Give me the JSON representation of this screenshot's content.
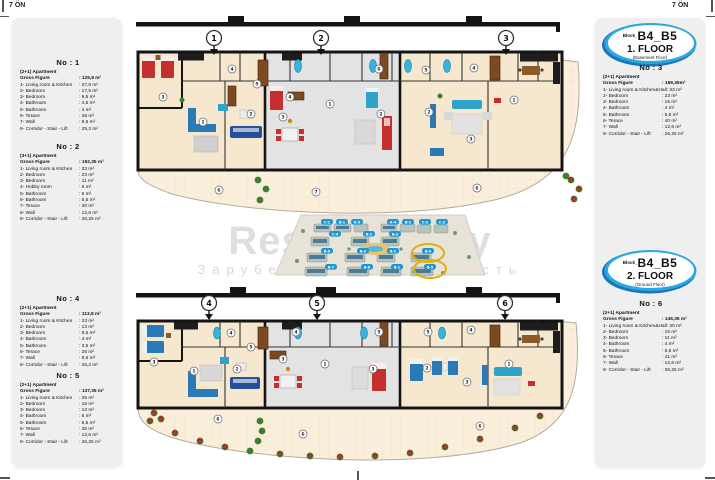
{
  "page": {
    "corner_left": "7 ÖN",
    "corner_right": "7 ÖN"
  },
  "watermark": {
    "title": "RestProperty",
    "subtitle": "Зарубежная недвижимость"
  },
  "colors": {
    "badge_blue": "#2aa9e0",
    "badge_dark_blue": "#1b75bb",
    "wall": "#1a1a1a",
    "floor_cream": "#f6e8cf",
    "floor_gray": "#e3e3e3",
    "terrace_cream": "#f9efdb",
    "furniture_red": "#c62f2f",
    "furniture_blue": "#2a7ab8",
    "furniture_navy": "#274f99",
    "tub_cyan": "#35b4dc",
    "plant_green": "#3f7d33",
    "label_blue": "#1f97d4",
    "highlight_yellow": "#e2b00c",
    "panel_gray": "#efefef"
  },
  "badges": {
    "floor1": {
      "block": "Block_",
      "name": "B4_B5",
      "floor": "1. FLOOR",
      "sub": "(Basement Floor)"
    },
    "floor2": {
      "block": "Block_",
      "name": "B4_B5",
      "floor": "2. FLOOR",
      "sub": "(Ground Floor)"
    }
  },
  "apartments": [
    {
      "no": "No : 1",
      "type": "(2+1) Apartment",
      "gross_label": "Gross Figure",
      "gross_value": ": 125,8 m²",
      "rows": [
        {
          "label": "1- Living room & Kitchen",
          "value": ": 27,5 m²"
        },
        {
          "label": "2- Bedroom",
          "value": ": 17,5 m²"
        },
        {
          "label": "3- Bedroom",
          "value": ": 9,5 m²"
        },
        {
          "label": "4- Bathroom",
          "value": ": 4,5 m²"
        },
        {
          "label": "5- Bathroom",
          "value": ": 4 m²"
        },
        {
          "label": "6- Terace",
          "value": ": 28 m²"
        },
        {
          "label": "7- Wall",
          "value": ": 9,6 m²"
        },
        {
          "label": "8- Corridor - Stair - Lift",
          "value": ": 25,2 m²"
        }
      ]
    },
    {
      "no": "No : 2",
      "type": "(3+1) Apartment",
      "gross_label": "Gross Figure",
      "gross_value": ": 152,35 m²",
      "rows": [
        {
          "label": "1- Living room & Kitchen",
          "value": ": 33 m²"
        },
        {
          "label": "2- Bedroom",
          "value": ": 23 m²"
        },
        {
          "label": "3- Bedroom",
          "value": ": 11 m²"
        },
        {
          "label": "4- Hobby room",
          "value": ": 6 m²"
        },
        {
          "label": "5- Bathroom",
          "value": ": 5 m²"
        },
        {
          "label": "6- Bathroom",
          "value": ": 5,5 m²"
        },
        {
          "label": "7- Terace",
          "value": ": 30 m²"
        },
        {
          "label": "8- Wall",
          "value": ": 12,6 m²"
        },
        {
          "label": "9- Corridor - Stair - Lift",
          "value": ": 26,25 m²"
        }
      ]
    },
    {
      "no": "No : 3",
      "type": "(2+1) Apartment",
      "gross_label": "Gross Figure",
      "gross_value": ": 159,35m²",
      "rows": [
        {
          "label": "1- Living room & Kitchen&Hall",
          "value": ": 33 m²"
        },
        {
          "label": "2- Bedroom",
          "value": ": 23 m²"
        },
        {
          "label": "3- Bedroom",
          "value": ": 15 m²"
        },
        {
          "label": "4- Bathroom",
          "value": ": 4 m²"
        },
        {
          "label": "5- Bathroom",
          "value": ": 5,5 m²"
        },
        {
          "label": "6- Terace",
          "value": ": 40 m²"
        },
        {
          "label": "7- Wall",
          "value": ": 12,6 m²"
        },
        {
          "label": "8- Corridor - Stair - Lift",
          "value": ": 26,25 m²"
        }
      ]
    },
    {
      "no": "No : 4",
      "type": "(2+1) Apartment",
      "gross_label": "Gross Figure",
      "gross_value": ": 113,8 m²",
      "rows": [
        {
          "label": "1- Living room & Kitchen",
          "value": ": 23 m²"
        },
        {
          "label": "2- Bedroom",
          "value": ": 13 m²"
        },
        {
          "label": "3- Bedroom",
          "value": ": 9,5 m²"
        },
        {
          "label": "4- Bathroom",
          "value": ": 4 m²"
        },
        {
          "label": "5- Bathroom",
          "value": ": 3,5 m²"
        },
        {
          "label": "6- Terace",
          "value": ": 26 m²"
        },
        {
          "label": "7- Wall",
          "value": ": 9,6 m²"
        },
        {
          "label": "8- Corridor - Stair - Lift",
          "value": ": 25,2 m²"
        }
      ]
    },
    {
      "no": "No : 5",
      "type": "(2+1) Apartment",
      "gross_label": "Gross Figure",
      "gross_value": ": 137,35 m²",
      "rows": [
        {
          "label": "1- Living room & Kitchen",
          "value": ": 25 m²"
        },
        {
          "label": "2- Bedroom",
          "value": ": 15 m²"
        },
        {
          "label": "3- Bedroom",
          "value": ": 13 m²"
        },
        {
          "label": "4- Bathroom",
          "value": ": 5 m²"
        },
        {
          "label": "5- Bathroom",
          "value": ": 5,5 m²"
        },
        {
          "label": "6- Terace",
          "value": ": 35 m²"
        },
        {
          "label": "7- Wall",
          "value": ": 12,6 m²"
        },
        {
          "label": "8- Corridor - Stair - Lift",
          "value": ": 26,25 m²"
        }
      ]
    },
    {
      "no": "No : 6",
      "type": "(2+1) Apartment",
      "gross_label": "Gross Figure",
      "gross_value": ": 145,35 m²",
      "rows": [
        {
          "label": "1- Living room & Kitchen&Hall",
          "value": ": 30 m²"
        },
        {
          "label": "2- Bedroom",
          "value": ": 15 m²"
        },
        {
          "label": "3- Bedroom",
          "value": ": 11 m²"
        },
        {
          "label": "4- Bathroom",
          "value": ": 4 m²"
        },
        {
          "label": "5- Bathroom",
          "value": ": 5,5 m²"
        },
        {
          "label": "6- Terace",
          "value": ": 41 m²"
        },
        {
          "label": "7- Wall",
          "value": ": 12,6 m²"
        },
        {
          "label": "8- Corridor - Stair - Lift",
          "value": ": 26,25 m²"
        }
      ]
    }
  ],
  "plans": {
    "top": {
      "entries": [
        "1",
        "2",
        "3"
      ],
      "rooms": [
        {
          "n": "3",
          "x": 33,
          "y": 89
        },
        {
          "n": "1",
          "x": 73,
          "y": 114
        },
        {
          "n": "2",
          "x": 121,
          "y": 106
        },
        {
          "n": "4",
          "x": 102,
          "y": 61
        },
        {
          "n": "5",
          "x": 127,
          "y": 76
        },
        {
          "n": "4",
          "x": 160,
          "y": 89
        },
        {
          "n": "3",
          "x": 153,
          "y": 109
        },
        {
          "n": "1",
          "x": 200,
          "y": 96
        },
        {
          "n": "2",
          "x": 251,
          "y": 106
        },
        {
          "n": "6",
          "x": 89,
          "y": 182
        },
        {
          "n": "7",
          "x": 186,
          "y": 184
        },
        {
          "n": "6",
          "x": 249,
          "y": 61
        },
        {
          "n": "5",
          "x": 296,
          "y": 62
        },
        {
          "n": "4",
          "x": 344,
          "y": 60
        },
        {
          "n": "2",
          "x": 299,
          "y": 104
        },
        {
          "n": "3",
          "x": 341,
          "y": 131
        },
        {
          "n": "1",
          "x": 384,
          "y": 92
        },
        {
          "n": "6",
          "x": 347,
          "y": 180
        }
      ]
    },
    "bottom": {
      "entries": [
        "4",
        "5",
        "6"
      ],
      "rooms": [
        {
          "n": "3",
          "x": 24,
          "y": 79
        },
        {
          "n": "1",
          "x": 64,
          "y": 88
        },
        {
          "n": "2",
          "x": 107,
          "y": 86
        },
        {
          "n": "4",
          "x": 101,
          "y": 50
        },
        {
          "n": "5",
          "x": 121,
          "y": 64
        },
        {
          "n": "4",
          "x": 166,
          "y": 49
        },
        {
          "n": "3",
          "x": 153,
          "y": 76
        },
        {
          "n": "1",
          "x": 195,
          "y": 81
        },
        {
          "n": "6",
          "x": 88,
          "y": 136
        },
        {
          "n": "6",
          "x": 173,
          "y": 151
        },
        {
          "n": "5",
          "x": 249,
          "y": 49
        },
        {
          "n": "5",
          "x": 298,
          "y": 49
        },
        {
          "n": "4",
          "x": 341,
          "y": 47
        },
        {
          "n": "3",
          "x": 243,
          "y": 86
        },
        {
          "n": "2",
          "x": 297,
          "y": 85
        },
        {
          "n": "3",
          "x": 337,
          "y": 99
        },
        {
          "n": "1",
          "x": 379,
          "y": 81
        },
        {
          "n": "6",
          "x": 350,
          "y": 143
        }
      ]
    }
  },
  "site_plan": {
    "labels": [
      {
        "t": "C-1",
        "x": 62,
        "y": 9
      },
      {
        "t": "B-1",
        "x": 77,
        "y": 9
      },
      {
        "t": "A-5",
        "x": 92,
        "y": 9
      },
      {
        "t": "A-4",
        "x": 128,
        "y": 9
      },
      {
        "t": "B-2",
        "x": 143,
        "y": 9
      },
      {
        "t": "C-2",
        "x": 160,
        "y": 9
      },
      {
        "t": "C-3",
        "x": 177,
        "y": 9
      },
      {
        "t": "C-4",
        "x": 70,
        "y": 21
      },
      {
        "t": "B-1",
        "x": 104,
        "y": 21
      },
      {
        "t": "B-3",
        "x": 130,
        "y": 21
      },
      {
        "t": "B-6",
        "x": 62,
        "y": 38
      },
      {
        "t": "B-3",
        "x": 98,
        "y": 38
      },
      {
        "t": "B-2",
        "x": 128,
        "y": 38
      },
      {
        "t": "B-4",
        "x": 163,
        "y": 38
      },
      {
        "t": "B-7",
        "x": 66,
        "y": 54
      },
      {
        "t": "B-8",
        "x": 102,
        "y": 54
      },
      {
        "t": "B-1",
        "x": 132,
        "y": 54
      },
      {
        "t": "B-5",
        "x": 165,
        "y": 54
      }
    ],
    "highlighted": [
      "B-4",
      "B-5"
    ]
  }
}
